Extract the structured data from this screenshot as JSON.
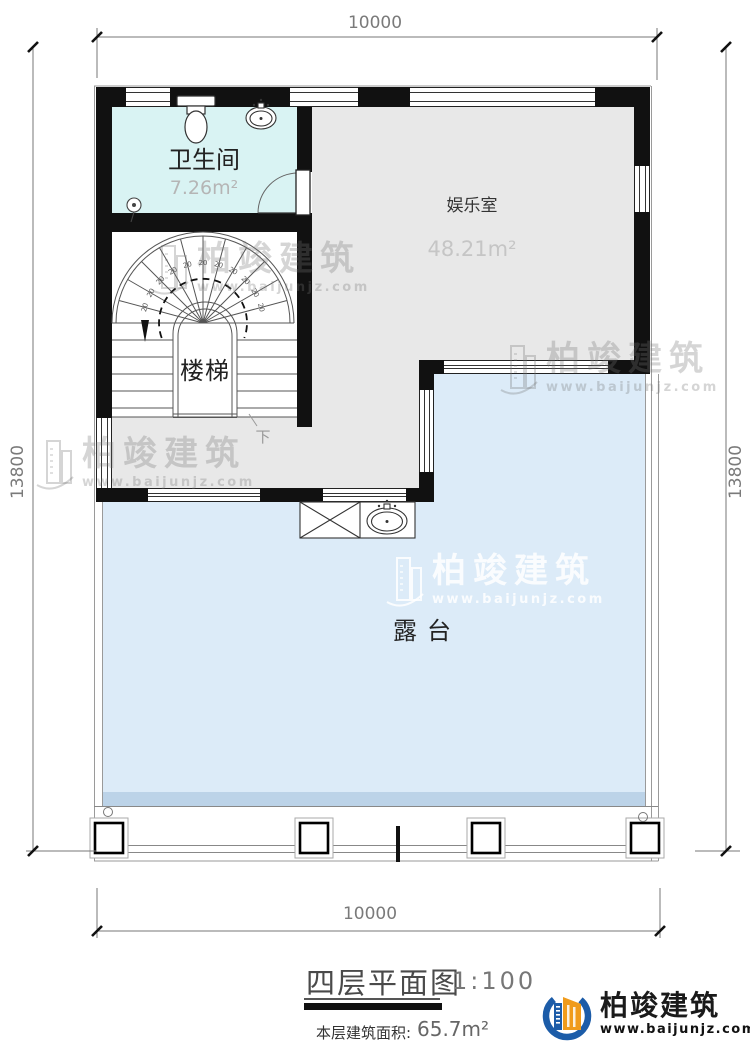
{
  "dimensions": {
    "top": "10000",
    "bottom": "10000",
    "left": "13800",
    "right": "13800"
  },
  "rooms": {
    "bathroom": {
      "name": "卫生间",
      "area": "7.26m²"
    },
    "entertainment": {
      "name": "娱乐室",
      "area": "48.21m²"
    },
    "stairs": {
      "name": "楼梯",
      "direction": "下",
      "tread": "20"
    },
    "terrace": {
      "name": "露台"
    }
  },
  "title_block": {
    "title": "四层平面图",
    "scale": "1:100",
    "area_label": "本层建筑面积:",
    "area_value": "65.7m²"
  },
  "brand": {
    "name": "柏竣建筑",
    "url": "www.baijunjz.com"
  },
  "colors": {
    "bathroom_fill": "#d9f3f3",
    "room_fill": "#e8e8e8",
    "terrace_fill": "#dcebf8",
    "terrace_edge": "#bcd3e8",
    "wall": "#111111",
    "logo_blue": "#1c5ca8",
    "logo_orange": "#f09b1b"
  }
}
